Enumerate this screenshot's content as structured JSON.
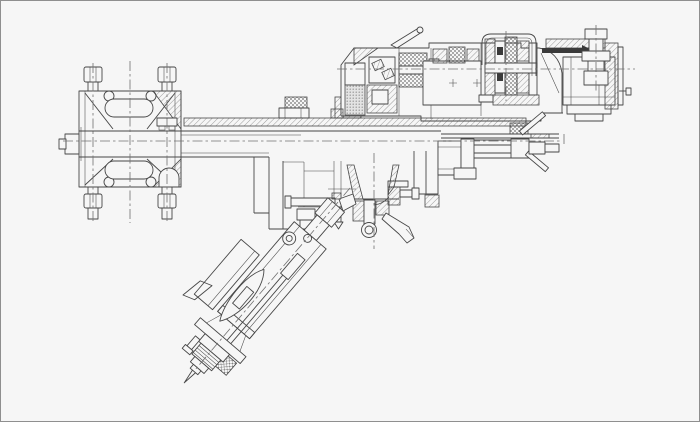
{
  "drawing": {
    "type": "mechanical-assembly-cross-section",
    "text_labels": [],
    "parts": [
      {
        "id": "mounting-flange",
        "label": "mounting flange with four bolts"
      },
      {
        "id": "main-shaft",
        "label": "main horizontal shaft tube"
      },
      {
        "id": "top-mounting-plate",
        "label": "hatched mounting plate"
      },
      {
        "id": "gear-train-housing",
        "label": "upper gear train housing"
      },
      {
        "id": "lubrication-pipe",
        "label": "curved lubrication pipe"
      },
      {
        "id": "shift-lever",
        "label": "shift lever"
      },
      {
        "id": "drive-unit",
        "label": "drive unit housing"
      },
      {
        "id": "pipe-fitting-stack",
        "label": "vertical pipe fitting stack"
      },
      {
        "id": "lower-housing",
        "label": "lower housing"
      },
      {
        "id": "discharge-funnel",
        "label": "discharge funnel with plug"
      },
      {
        "id": "sight-glass",
        "label": "sight glass circle"
      },
      {
        "id": "deflector-blade",
        "label": "deflector blade"
      },
      {
        "id": "output-shaft",
        "label": "output shaft with clamp handles"
      },
      {
        "id": "angled-cylinder",
        "label": "angled cylinder assembly"
      },
      {
        "id": "piston-rod",
        "label": "piston rod with elbow joint"
      },
      {
        "id": "tool-flange",
        "label": "tool head flange"
      },
      {
        "id": "collet-nose",
        "label": "ribbed collet nose"
      },
      {
        "id": "tool-bit",
        "label": "pointed tool bit"
      }
    ]
  },
  "canvas": {
    "background": "#f6f6f6",
    "border": "#8f8f8f",
    "line": "#474747",
    "centerline": "#707070",
    "hatch": "#5f5f5f",
    "dark_fill": "#3a3a3a",
    "mid_fill": "#c9c9c9",
    "white": "#fbfbfb"
  }
}
